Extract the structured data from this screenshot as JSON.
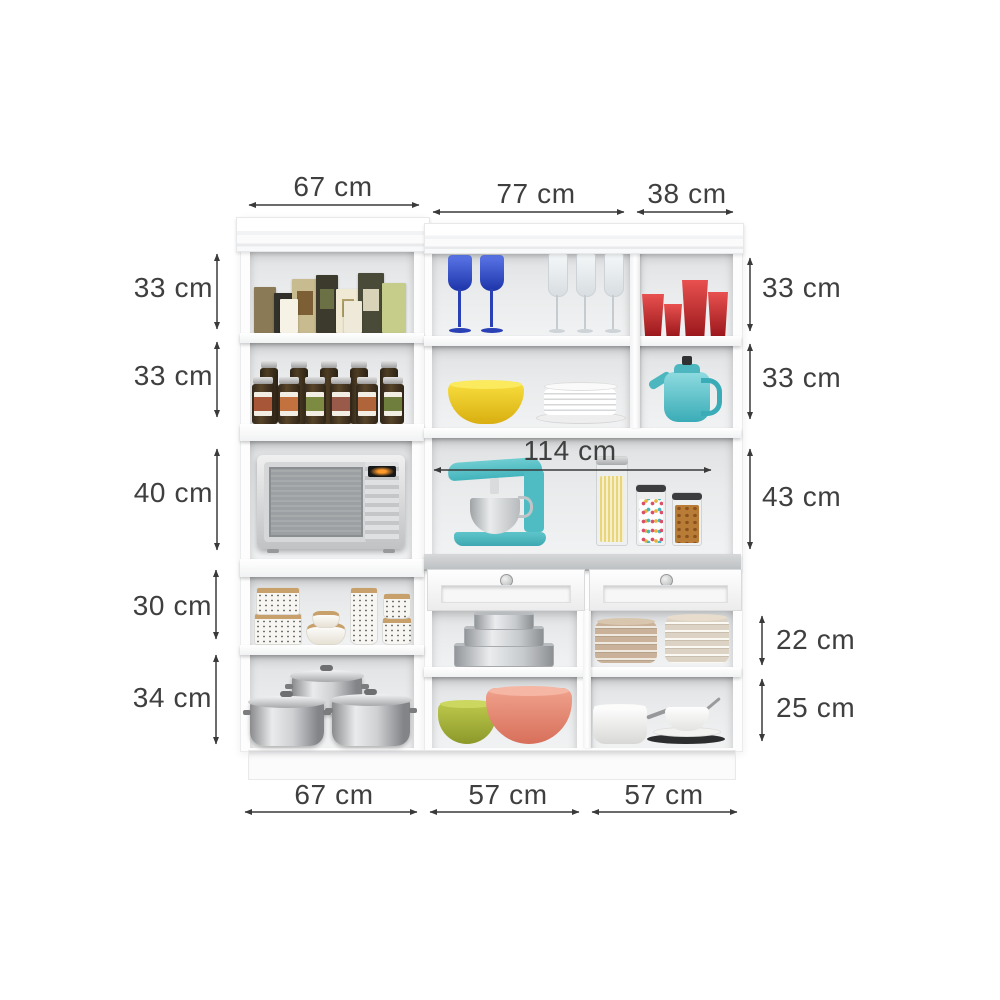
{
  "diagram": {
    "subject": "White kitchen cabinet unit with shelves, microwave niche, counter, drawers and dimension annotations",
    "unit": "cm",
    "background": "#ffffff",
    "text_color": "#3f3f3f"
  },
  "dims": {
    "top": [
      {
        "label": "67 cm"
      },
      {
        "label": "77 cm"
      },
      {
        "label": "38 cm"
      }
    ],
    "left": [
      {
        "label": "33 cm"
      },
      {
        "label": "33 cm"
      },
      {
        "label": "40 cm"
      },
      {
        "label": "30 cm"
      },
      {
        "label": "34 cm"
      }
    ],
    "right": [
      {
        "label": "33 cm"
      },
      {
        "label": "33 cm"
      },
      {
        "label": "43 cm"
      },
      {
        "label": "22 cm"
      },
      {
        "label": "25 cm"
      }
    ],
    "center": [
      {
        "label": "114 cm"
      }
    ],
    "bottom": [
      {
        "label": "67 cm"
      },
      {
        "label": "57 cm"
      },
      {
        "label": "57 cm"
      }
    ]
  },
  "colors": {
    "cabinet_white": "#fdfdfd",
    "interior_gray": "#e2e4e6",
    "countertop_gray": "#c3c6c8",
    "arrow_black": "#3a3a3a",
    "teal": "#57c4cb",
    "red": "#c5292d",
    "yellow": "#f2d32c",
    "blue": "#3553cc",
    "green": "#a3b13a",
    "coral": "#e08873",
    "plate_tan": "#c9b299"
  }
}
